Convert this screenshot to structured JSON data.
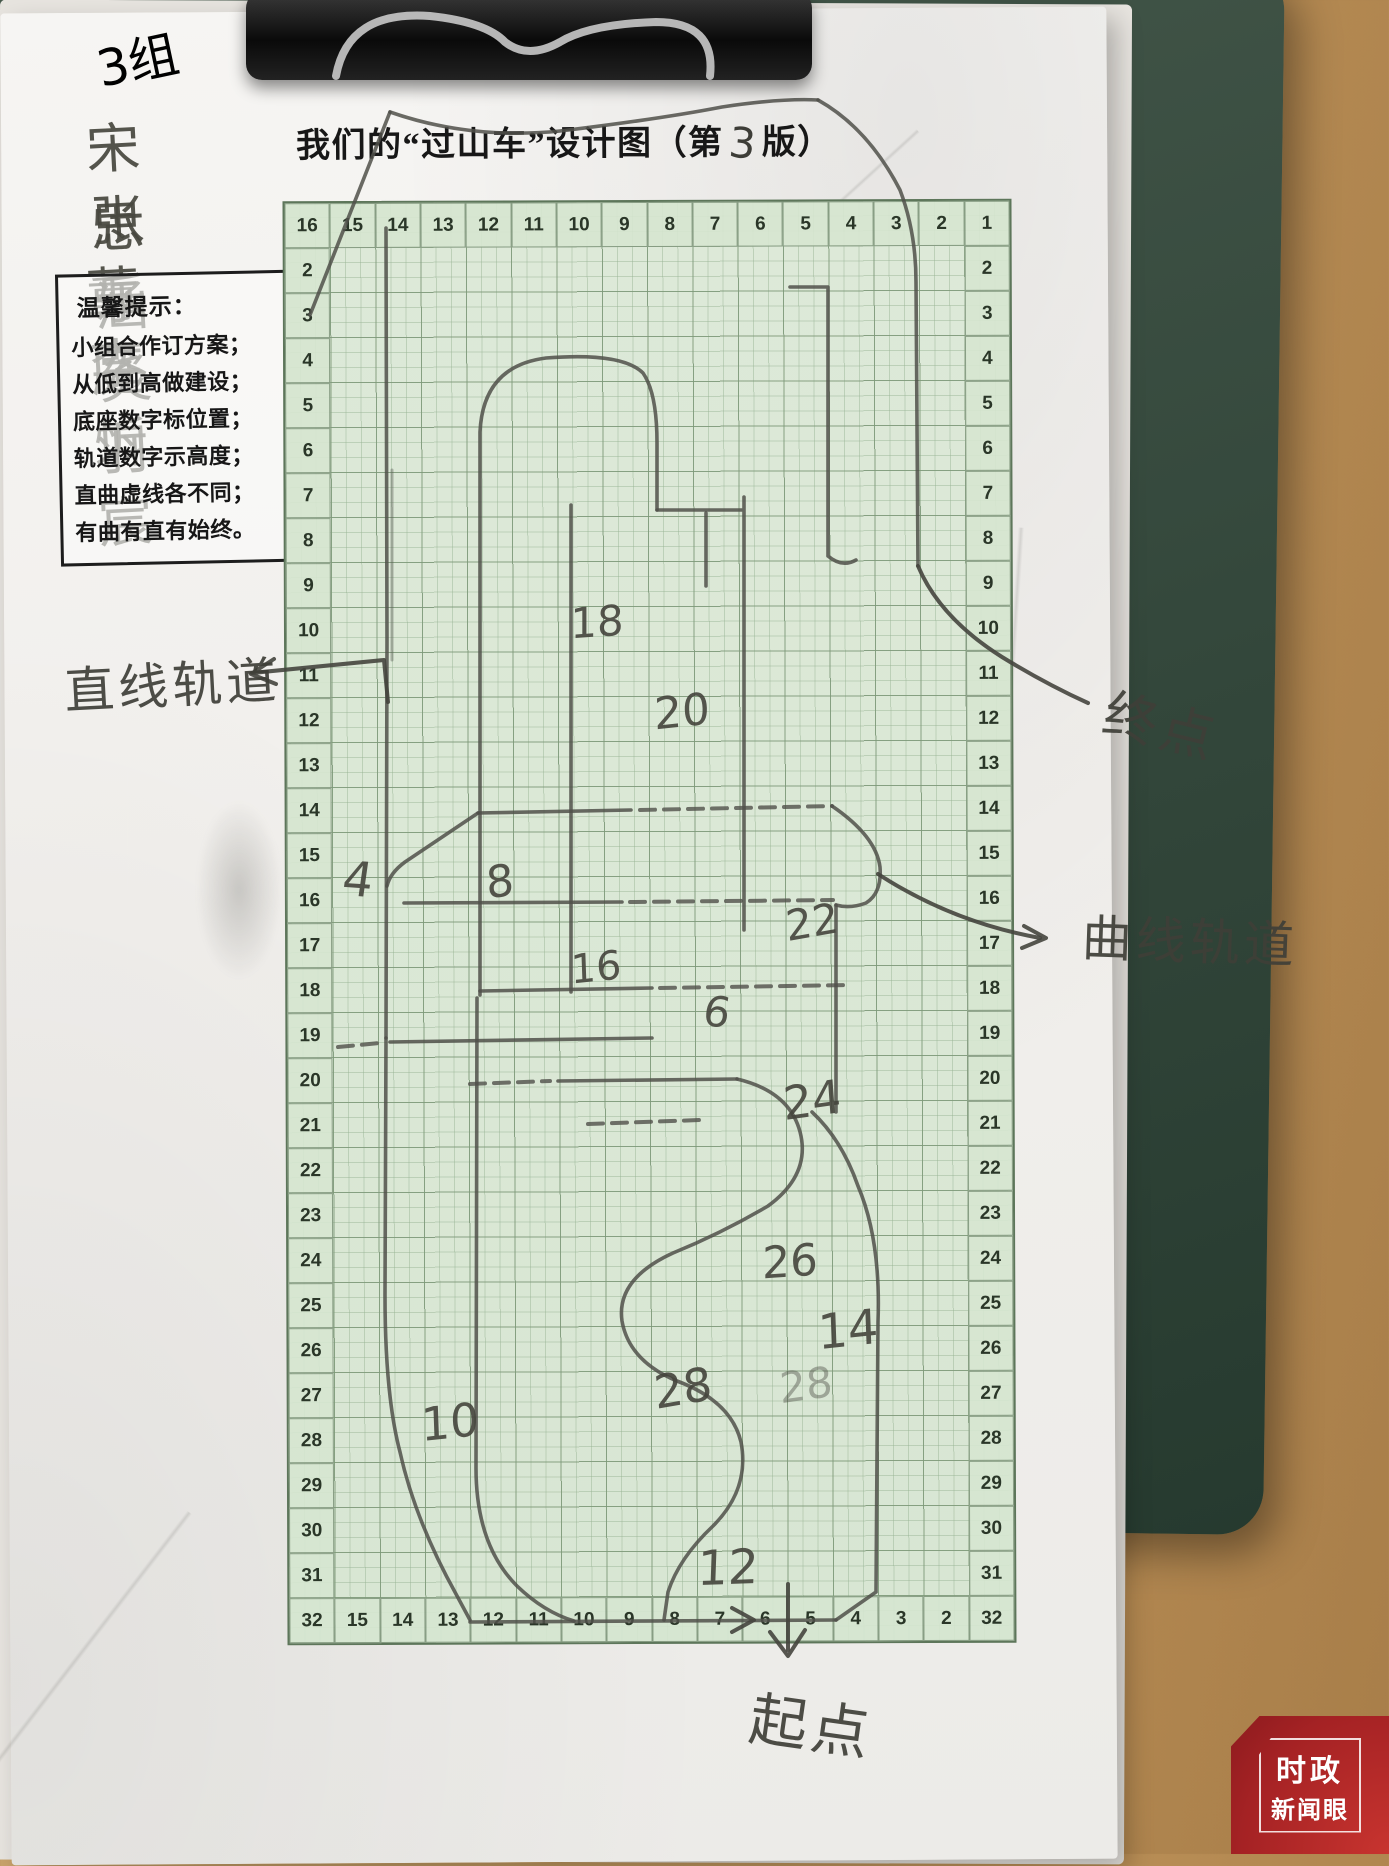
{
  "title": {
    "pre": "我们的“过山车”设计图（第",
    "num": "3",
    "post": "版）"
  },
  "group_label": "3组",
  "names": [
    "宋思涵",
    "张乐炎",
    "董庭羽",
    "李忻宸"
  ],
  "tips": {
    "title": "温馨提示：",
    "lines": [
      "小组合作订方案；",
      "从低到高做建设；",
      "底座数字标位置；",
      "轨道数字示高度；",
      "直曲虚线各不同；",
      "有曲有直有始终。"
    ]
  },
  "grid": {
    "top_row": [
      "16",
      "15",
      "14",
      "13",
      "12",
      "11",
      "10",
      "9",
      "8",
      "7",
      "6",
      "5",
      "4",
      "3",
      "2",
      "1"
    ],
    "bottom_row": [
      "32",
      "15",
      "14",
      "13",
      "12",
      "11",
      "10",
      "9",
      "8",
      "7",
      "6",
      "5",
      "4",
      "3",
      "2",
      "32"
    ],
    "left_col": [
      "2",
      "3",
      "4",
      "5",
      "6",
      "7",
      "8",
      "9",
      "10",
      "11",
      "12",
      "13",
      "14",
      "15",
      "16",
      "17",
      "18",
      "19",
      "20",
      "21",
      "22",
      "23",
      "24",
      "25",
      "26",
      "27",
      "28",
      "29",
      "30",
      "31"
    ],
    "right_col": [
      "2",
      "3",
      "4",
      "5",
      "6",
      "7",
      "8",
      "9",
      "10",
      "11",
      "12",
      "13",
      "14",
      "15",
      "16",
      "17",
      "18",
      "19",
      "20",
      "21",
      "22",
      "23",
      "24",
      "25",
      "26",
      "27",
      "28",
      "29",
      "30",
      "31"
    ]
  },
  "track_numbers": [
    {
      "v": "18",
      "x": 597,
      "y": 622,
      "s": 42,
      "r": -4,
      "faint": false
    },
    {
      "v": "20",
      "x": 682,
      "y": 712,
      "s": 44,
      "r": -6,
      "faint": false
    },
    {
      "v": "4",
      "x": 358,
      "y": 880,
      "s": 48,
      "r": 4,
      "faint": false
    },
    {
      "v": "8",
      "x": 500,
      "y": 882,
      "s": 44,
      "r": -8,
      "faint": false
    },
    {
      "v": "22",
      "x": 812,
      "y": 922,
      "s": 42,
      "r": -10,
      "faint": false
    },
    {
      "v": "16",
      "x": 596,
      "y": 968,
      "s": 40,
      "r": -6,
      "faint": false
    },
    {
      "v": "6",
      "x": 717,
      "y": 1012,
      "s": 42,
      "r": 6,
      "faint": false
    },
    {
      "v": "24",
      "x": 812,
      "y": 1100,
      "s": 46,
      "r": -8,
      "faint": false
    },
    {
      "v": "26",
      "x": 790,
      "y": 1262,
      "s": 44,
      "r": -4,
      "faint": false
    },
    {
      "v": "14",
      "x": 848,
      "y": 1330,
      "s": 48,
      "r": -6,
      "faint": false
    },
    {
      "v": "28",
      "x": 683,
      "y": 1388,
      "s": 46,
      "r": -10,
      "faint": false
    },
    {
      "v": "28",
      "x": 806,
      "y": 1385,
      "s": 42,
      "r": -8,
      "faint": true
    },
    {
      "v": "10",
      "x": 450,
      "y": 1422,
      "s": 46,
      "r": -6,
      "faint": false
    },
    {
      "v": "12",
      "x": 728,
      "y": 1568,
      "s": 48,
      "r": -2,
      "faint": false
    }
  ],
  "annotations": [
    {
      "id": "straight-track",
      "text": "直线轨道",
      "x": 172,
      "y": 682,
      "s": 50,
      "r": -3
    },
    {
      "id": "end-point",
      "text": "终点",
      "x": 1162,
      "y": 722,
      "s": 54,
      "r": 14
    },
    {
      "id": "curved-track",
      "text": "曲线轨道",
      "x": 1190,
      "y": 938,
      "s": 50,
      "r": 2
    },
    {
      "id": "start-point",
      "text": "起点",
      "x": 812,
      "y": 1722,
      "s": 58,
      "r": 8
    }
  ],
  "watermark": {
    "line1": "时政",
    "line2": "新闻眼",
    "color": "#a52224"
  }
}
